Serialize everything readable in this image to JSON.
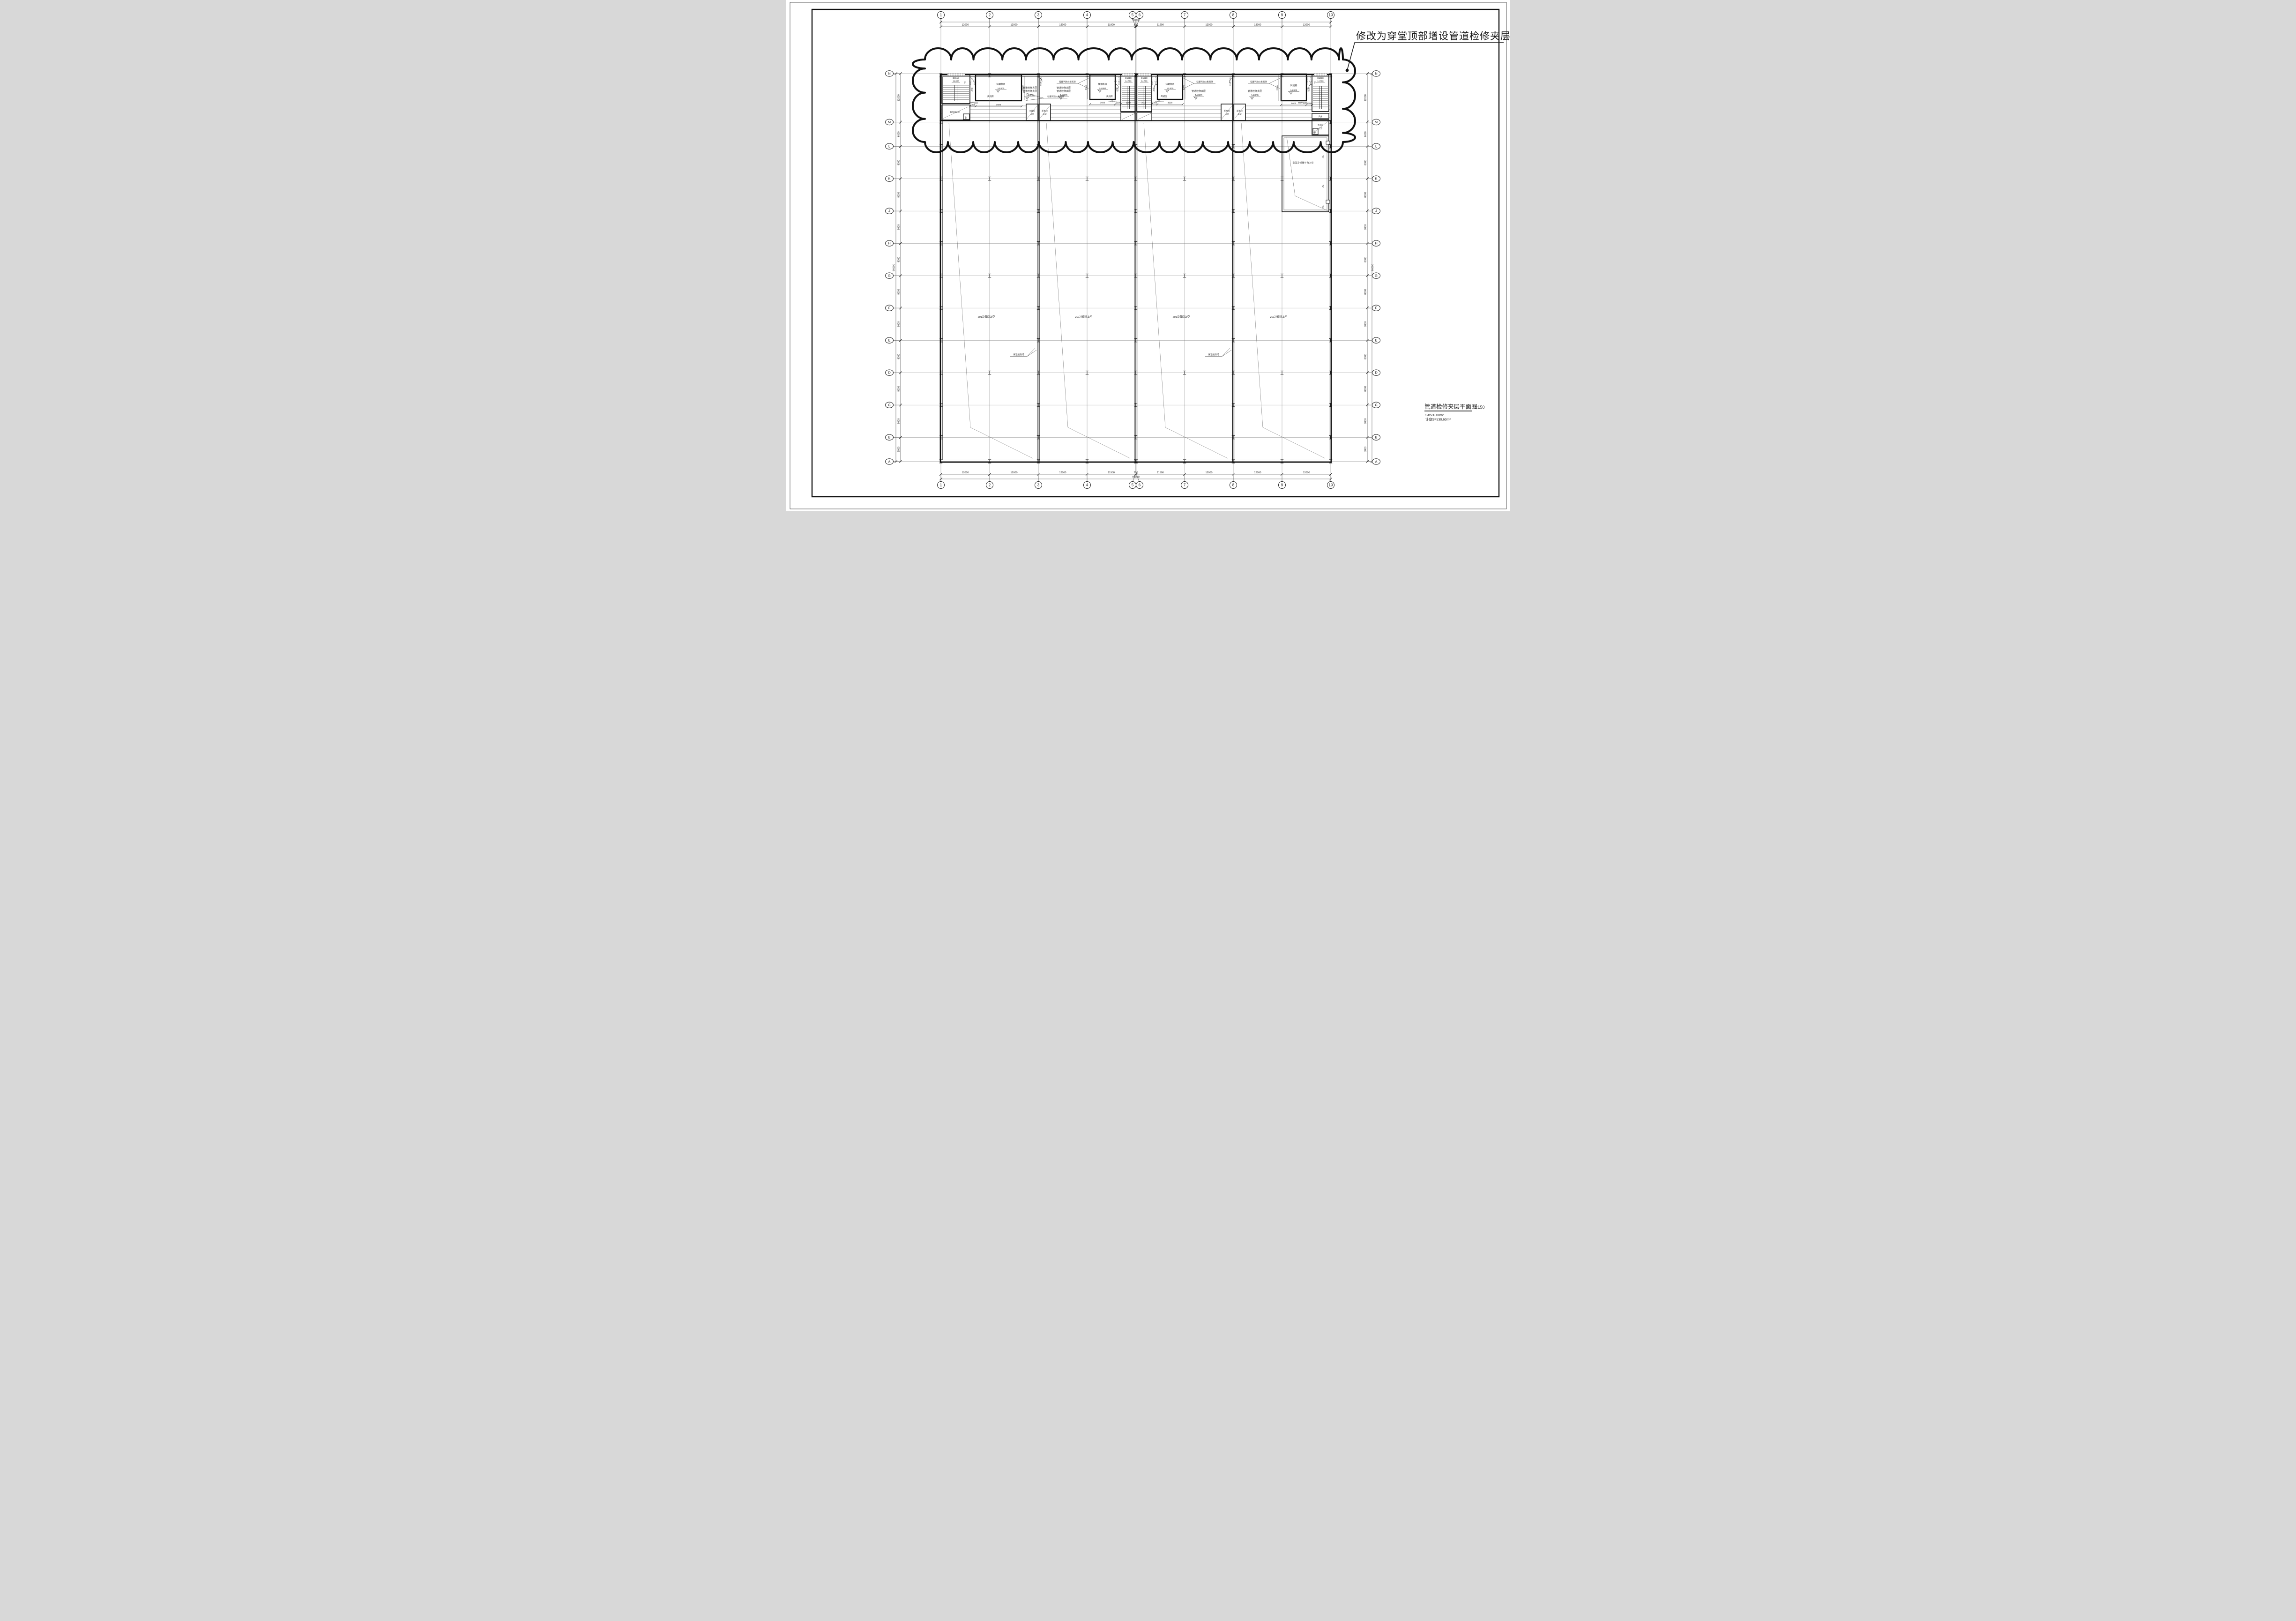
{
  "annotation": {
    "text": "修改为穿堂顶部增设管道检修夹层"
  },
  "title_block": {
    "title": "管道检修夹层平面图",
    "scale": "1:150",
    "area": "S=530.60m²",
    "area_plot": "计容S=530.60m²"
  },
  "grid": {
    "cols": {
      "labels": [
        "1",
        "2",
        "3",
        "4",
        "5",
        "6",
        "7",
        "8",
        "9",
        "10"
      ],
      "spans": [
        "12000",
        "12000",
        "12000",
        "11900",
        "200",
        "11900",
        "12000",
        "12000",
        "12000"
      ],
      "total": "96000"
    },
    "rows": {
      "labels": [
        "N",
        "M",
        "L",
        "K",
        "J",
        "H",
        "G",
        "F",
        "E",
        "D",
        "C",
        "B",
        "A"
      ],
      "spans": [
        "12000",
        "6000",
        "8000",
        "8000",
        "8000",
        "8000",
        "8000",
        "8000",
        "8000",
        "8000",
        "8000",
        "6000"
      ],
      "total": "96000"
    }
  },
  "labels": {
    "smoke_room": "排烟机房",
    "fan_room": "风机房",
    "level": "14.800",
    "corridor": "过道",
    "stair_door": "D1518",
    "down": "下",
    "fm_a": "FM甲1121",
    "fm_b": "FM乙1121",
    "mezzanine": "管道检修夹层",
    "fire_board": "硅酸钙防火板到顶",
    "dist_above": "配电间上空",
    "dist_1": "配电间",
    "tool_1": "工具间",
    "above": "上空",
    "heat_shaft": "暖井",
    "air_shaft": "风井",
    "cold_above": "201冷藏间上空",
    "platform": "蒸发冷设施平台上空",
    "slope": "2%",
    "insul_note": "保温板封闭",
    "d1300": "1300",
    "d3500": "3500",
    "d3600": "3600",
    "d5000": "5000",
    "d5600": "5600"
  }
}
